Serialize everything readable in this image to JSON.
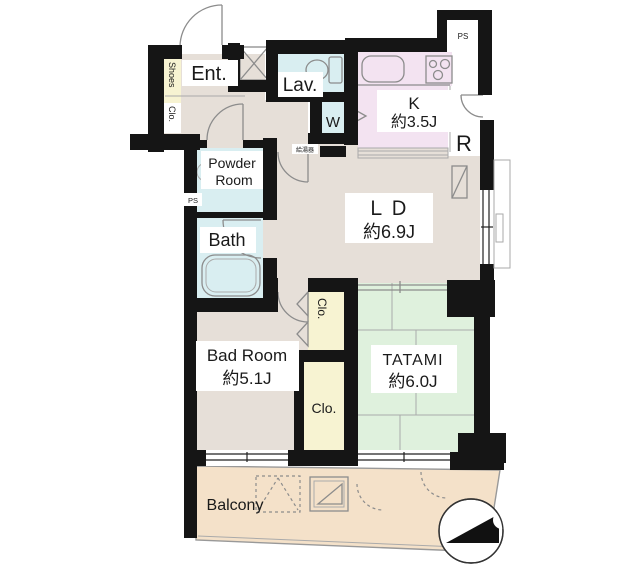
{
  "plan": {
    "entrance": {
      "label": "Ent."
    },
    "shoes_closet": {
      "line1": "Shoes",
      "line2": "Clo."
    },
    "lavatory": {
      "label": "Lav."
    },
    "washer_space": {
      "label": "W"
    },
    "kitchen": {
      "label": "K",
      "size": "約3.5J"
    },
    "refrigerator_space": {
      "label": "R"
    },
    "pipe_shaft_top": {
      "label": "PS"
    },
    "pipe_shaft_side": {
      "label": "PS"
    },
    "water_heater": {
      "label": "給湯器"
    },
    "powder_room": {
      "line1": "Powder",
      "line2": "Room"
    },
    "bathroom": {
      "label": "Bath"
    },
    "living_dining": {
      "label": "ＬＤ",
      "size": "約6.9J"
    },
    "bedroom": {
      "label": "Bad Room",
      "size": "約5.1J"
    },
    "tatami_room": {
      "label": "TATAMI",
      "size": "約6.0J"
    },
    "closet_bedroom": {
      "label": "Clo."
    },
    "closet_hall": {
      "label": "Clo."
    },
    "balcony": {
      "label": "Balcony"
    }
  },
  "colors": {
    "wall": "#151515",
    "floor": "#e6dfd8",
    "wet_area": "#d9eef1",
    "kitchen": "#f3e3f1",
    "tatami": "#dff1dd",
    "closet": "#f7f3d2",
    "balcony": "#f4e1c9",
    "line": "#8c8c8c",
    "label_text": "#1a1a1a",
    "white": "#ffffff"
  }
}
